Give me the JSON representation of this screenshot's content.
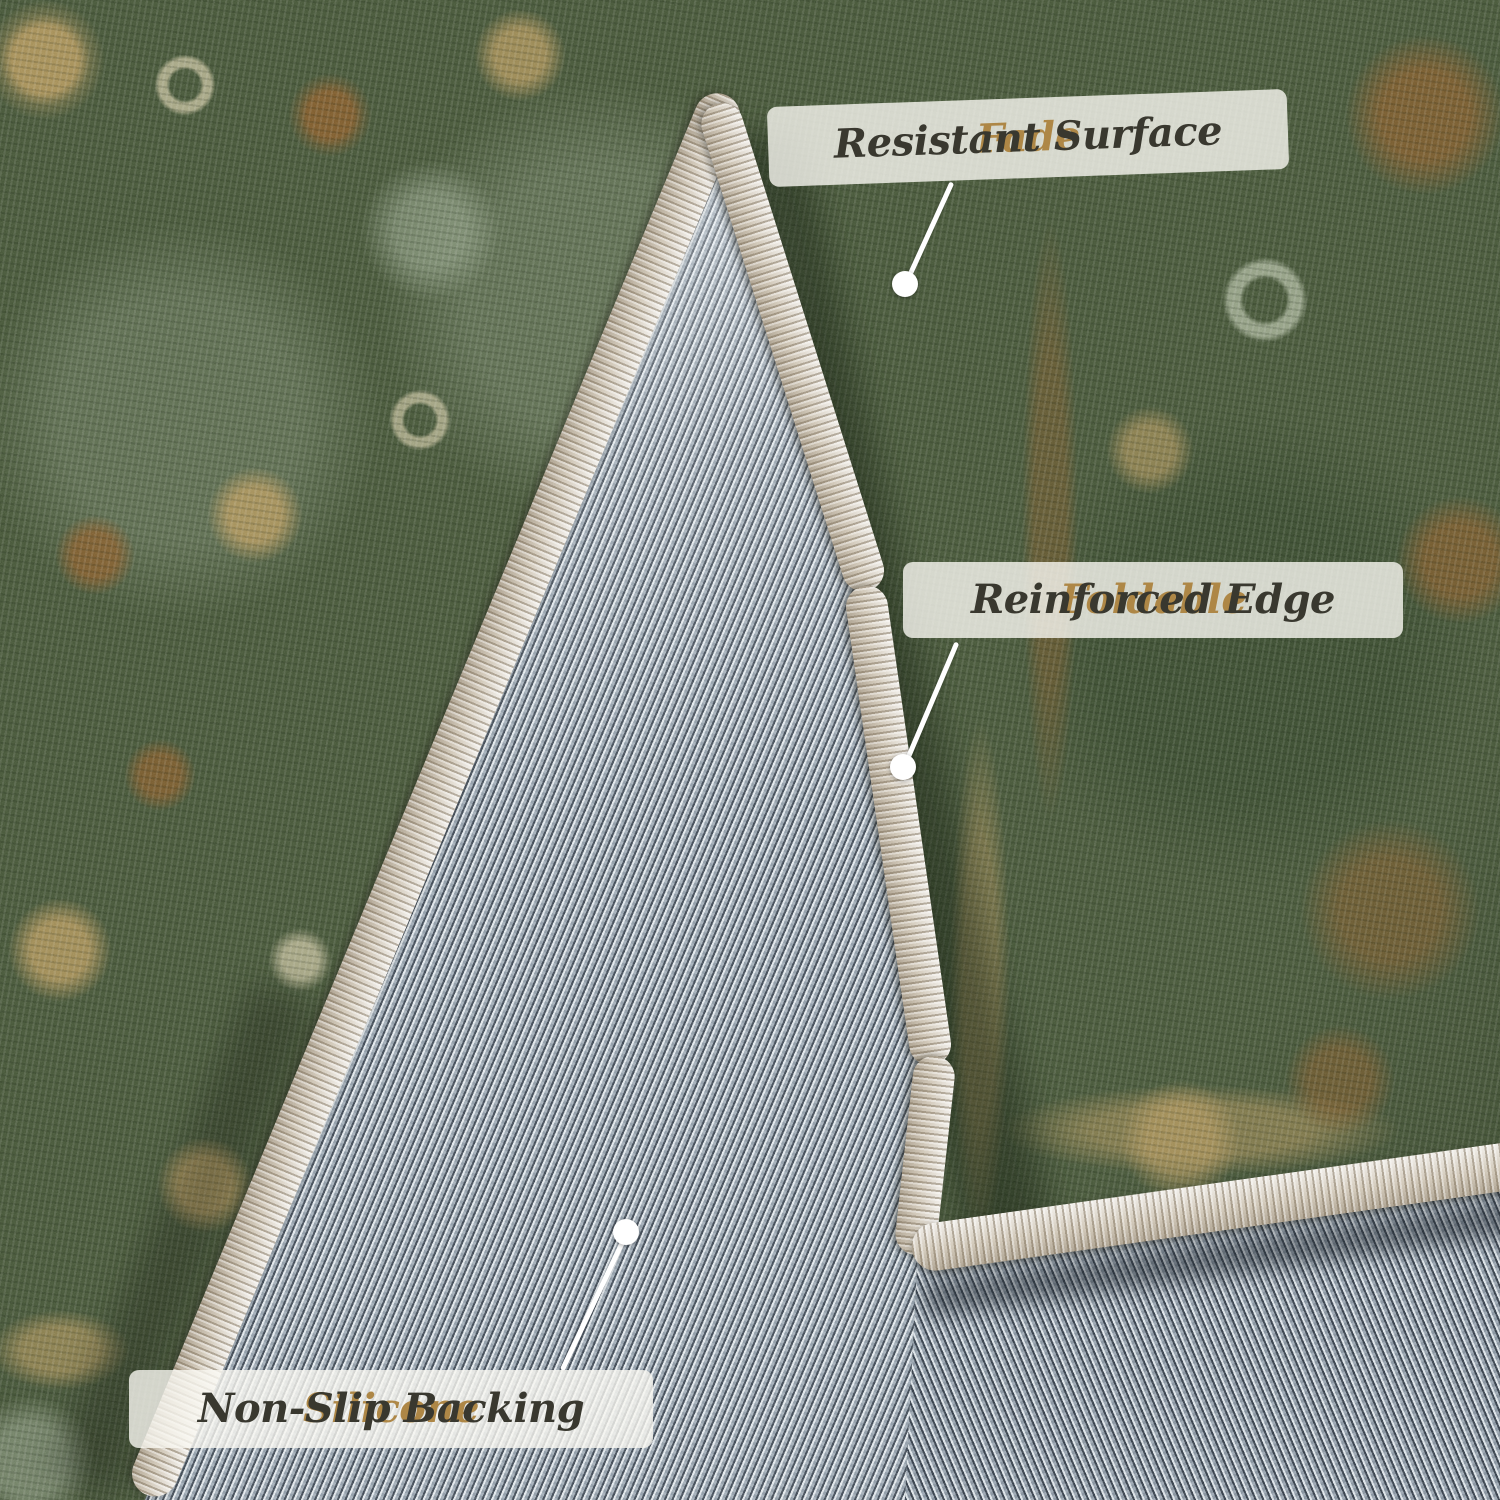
{
  "callouts": [
    {
      "highlight": "Fade",
      "rest": "Resistant Surface"
    },
    {
      "highlight": "Foldable",
      "rest": "Reinforced Edge"
    },
    {
      "highlight": "Silicone",
      "rest": "Non-Slip Backing"
    }
  ],
  "colors": {
    "highlight_gold": "#ae8746",
    "label_text": "#39382f",
    "label_background": "rgba(249,247,241,0.8)",
    "pointer_white": "#ffffff",
    "rug_green": "#475739",
    "backing_gray": "#a2aeb9",
    "binding_cream": "#d8d0c2"
  }
}
